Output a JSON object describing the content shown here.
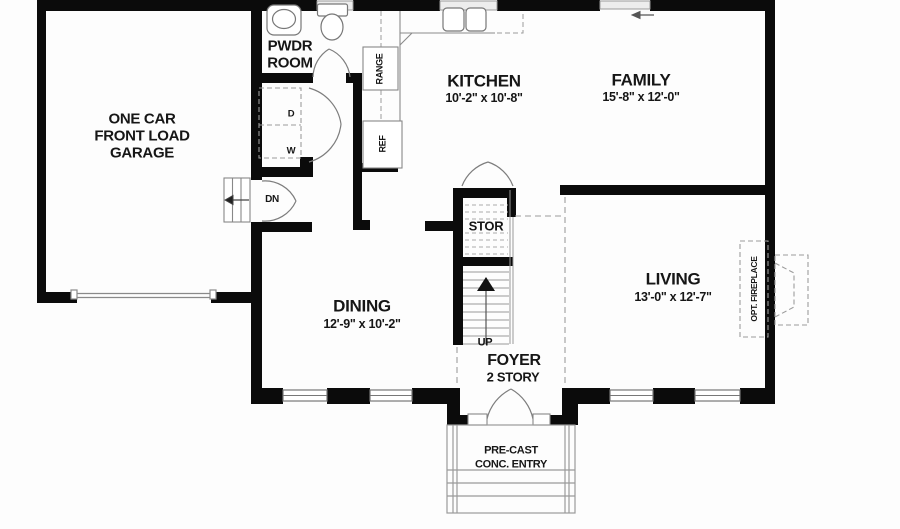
{
  "rooms": {
    "garage": {
      "line1": "ONE CAR",
      "line2": "FRONT LOAD",
      "line3": "GARAGE"
    },
    "pwdr": {
      "line1": "PWDR",
      "line2": "ROOM"
    },
    "kitchen": {
      "name": "KITCHEN",
      "dims": "10'-2\" x 10'-8\""
    },
    "family": {
      "name": "FAMILY",
      "dims": "15'-8\" x 12'-0\""
    },
    "dining": {
      "name": "DINING",
      "dims": "12'-9\" x 10'-2\""
    },
    "living": {
      "name": "LIVING",
      "dims": "13'-0\" x 12'-7\""
    },
    "foyer": {
      "name": "FOYER",
      "sub": "2 STORY"
    },
    "stor": {
      "name": "STOR"
    }
  },
  "annotations": {
    "up": "UP",
    "dn": "DN",
    "range": "RANGE",
    "ref": "REF",
    "dryer": "D",
    "washer": "W",
    "opt_fireplace": "OPT. FIREPLACE",
    "entry_line1": "PRE-CAST",
    "entry_line2": "CONC. ENTRY"
  },
  "colors": {
    "wall": "#0b0b0b",
    "thin_line": "#7d7d7d",
    "dashed_line": "#9c9c9c",
    "window_fill": "#ededed",
    "background": "#fdfdfd",
    "text": "#161616"
  }
}
